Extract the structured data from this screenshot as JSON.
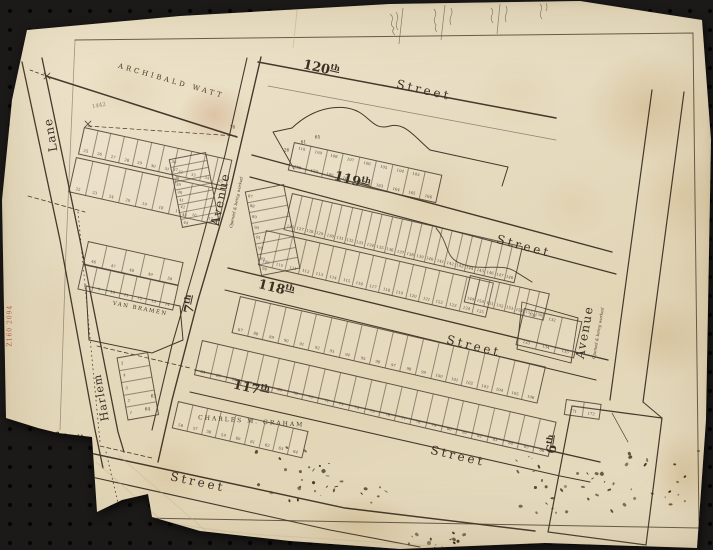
{
  "streets": [
    {
      "num": "120",
      "suf": "th",
      "word": "Street"
    },
    {
      "num": "119",
      "suf": "th",
      "word": "Street"
    },
    {
      "num": "118",
      "suf": "th",
      "word": "Street"
    },
    {
      "num": "117",
      "suf": "th",
      "word": "Street"
    },
    {
      "num": "116",
      "suf": "th",
      "word": "Street"
    }
  ],
  "avenues": [
    {
      "num": "7",
      "suf": "th",
      "word": "Avenue",
      "note": "Opened & being worked"
    },
    {
      "num": "6",
      "suf": "th",
      "word": "Avenue",
      "note": "Opened & being worked"
    }
  ],
  "lane": {
    "harlem": "Harlem",
    "lane": "Lane"
  },
  "owners": {
    "watt": "ARCHIBALD  WATT",
    "van_bramen": "VAN  BRAMEN",
    "graham": "CHARLES   M.   GRAHAM"
  },
  "catalog_mark": "Z160 2094",
  "pencil_note": "1442",
  "lots": {
    "lane_block_upper": {
      "bottom": [
        25,
        26,
        27,
        28,
        29,
        30,
        31,
        32,
        33,
        34,
        35
      ]
    },
    "lane_block_lower": {
      "bottom": [
        22,
        23,
        24,
        20,
        19,
        18,
        17,
        16,
        15
      ]
    },
    "lane_block_avenue_column": {
      "bottom": [
        36,
        37,
        38,
        39,
        40,
        41,
        42,
        43,
        44
      ]
    },
    "small_block_upper": {
      "bottom": [
        46,
        47,
        48,
        49,
        50
      ]
    },
    "small_block_lower": {
      "bottom": [
        8,
        9,
        10,
        11,
        12,
        13,
        14
      ]
    },
    "harlem_column": {
      "bottom": [
        5,
        4,
        3,
        2,
        1
      ]
    },
    "block_119_120": {
      "top": [
        "110",
        "109",
        "108",
        "107",
        "106",
        "105",
        "104",
        "103",
        ""
      ],
      "bottom": [
        158,
        159,
        160,
        161,
        162,
        163,
        164,
        165,
        166
      ]
    },
    "block_118_119_north": {
      "bottom": [
        126,
        127,
        128,
        129,
        130,
        131,
        132,
        133,
        134,
        135,
        136,
        137,
        138,
        139,
        140,
        141,
        142,
        143,
        144,
        145,
        146,
        147,
        148
      ]
    },
    "block_118_119_south": {
      "bottom": [
        109,
        110,
        111,
        112,
        113,
        114,
        115,
        116,
        117,
        118,
        119,
        120,
        121,
        122,
        123,
        124,
        125
      ]
    },
    "block_118_119_southeast": {
      "bottom": [
        149,
        150,
        151,
        152,
        153,
        154,
        155,
        156
      ]
    },
    "block_118_119_avenue_column": {
      "bottom": [
        87,
        88,
        89,
        90,
        91,
        92,
        93,
        94
      ]
    },
    "block_118_119_tail": {
      "top": [
        "131",
        "132",
        ""
      ],
      "bottom": [
        133,
        134,
        135
      ]
    },
    "block_117_118_north": {
      "bottom": [
        87,
        88,
        89,
        90,
        91,
        92,
        93,
        94,
        95,
        96,
        97,
        98,
        99,
        100,
        101,
        102,
        103,
        104,
        105,
        106
      ]
    },
    "block_117_118_south": {
      "bottom": [
        64,
        65,
        66,
        67,
        68,
        69,
        70,
        71,
        72,
        73,
        74,
        75,
        76,
        77,
        78,
        79,
        80,
        81,
        82,
        83,
        84,
        85,
        86
      ]
    },
    "block_116_117_north": {
      "bottom": [
        56,
        57,
        58,
        59,
        60,
        61,
        62,
        63,
        64
      ]
    },
    "sixth_avenue_block_corner": {
      "bottom": [
        171,
        172
      ]
    }
  },
  "map_singles": [
    {
      "t": "76",
      "x": 228,
      "y": 124
    },
    {
      "t": "26",
      "x": 282,
      "y": 147
    },
    {
      "t": "61",
      "x": 299,
      "y": 139
    },
    {
      "t": "65",
      "x": 313,
      "y": 134
    },
    {
      "t": "63",
      "x": 149,
      "y": 393
    },
    {
      "t": "64",
      "x": 143,
      "y": 406
    }
  ],
  "colors": {
    "paper": "#e6dcc3",
    "ink": "#44392b",
    "red_mark": "#b23b2a",
    "board": "#1c1a18"
  }
}
